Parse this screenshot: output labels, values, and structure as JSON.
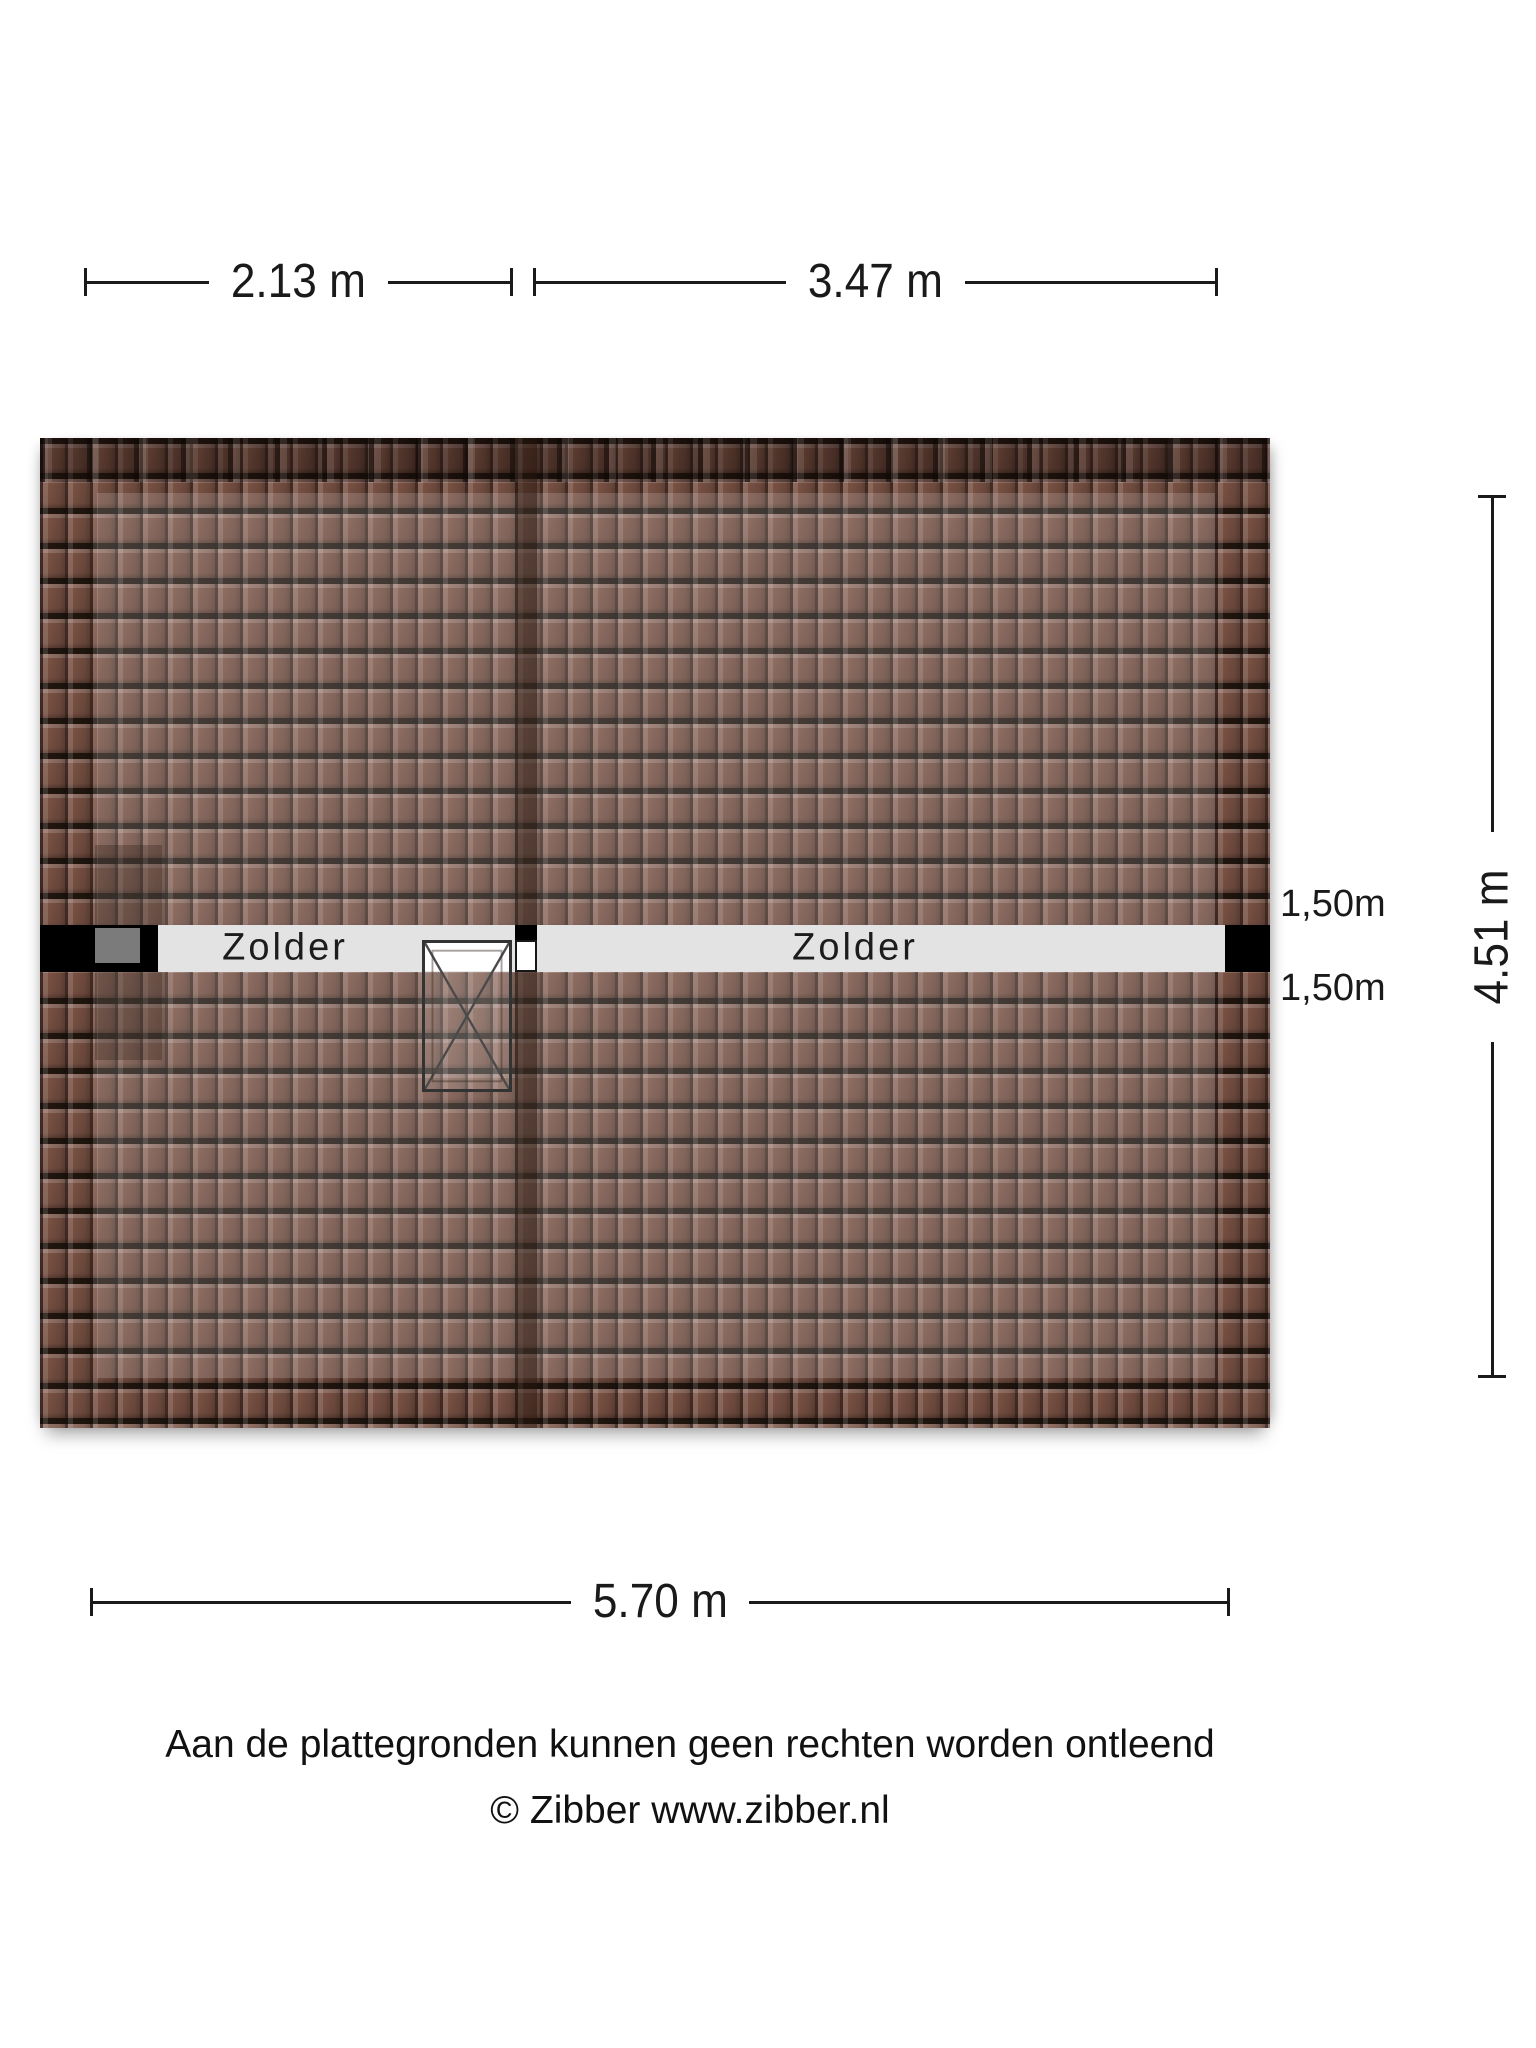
{
  "dimensions": {
    "top_left": "2.13 m",
    "top_right": "3.47 m",
    "bottom": "5.70 m",
    "side": "4.51 m",
    "headroom_top": "1,50m",
    "headroom_bottom": "1,50m"
  },
  "rooms": [
    {
      "label": "Zolder"
    },
    {
      "label": "Zolder"
    }
  ],
  "footer": {
    "line1": "Aan de plattegronden kunnen geen rechten worden ontleend",
    "line2": "© Zibber www.zibber.nl"
  },
  "colors": {
    "roof_tile": "#7a5244",
    "roof_gap": "#21160f",
    "floor_strip": "#e3e3e3",
    "wall": "#000000",
    "chimney": "#7b7b7b",
    "text": "#1a1a1a",
    "page_bg": "#ffffff"
  }
}
